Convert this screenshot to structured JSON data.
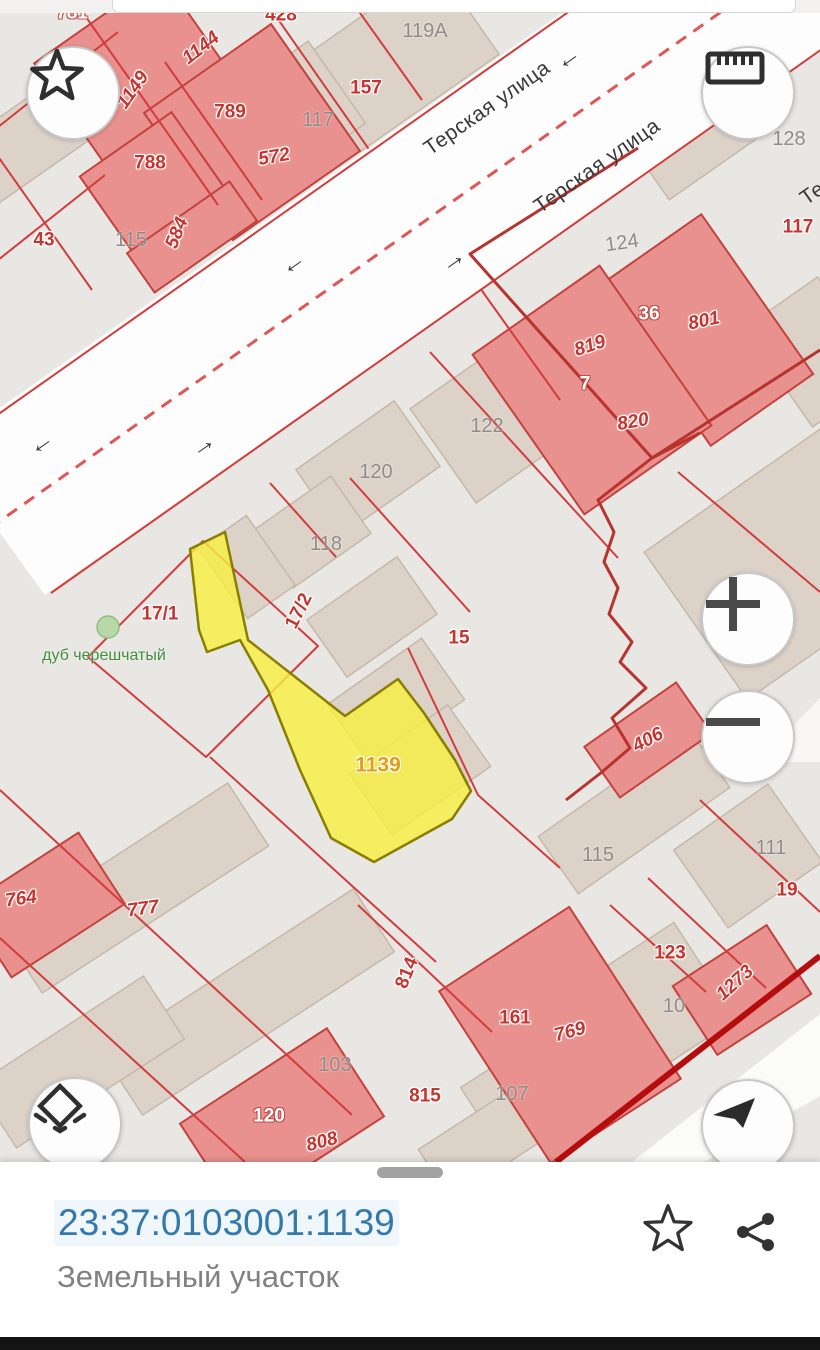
{
  "map": {
    "selected_parcel": {
      "number": "1139",
      "fill": "#f7f03e",
      "outline": "#8a7e00"
    },
    "labels": [
      {
        "text": "781",
        "x": 72,
        "y": 13,
        "rot": 0,
        "style": "wb"
      },
      {
        "text": "428",
        "x": 281,
        "y": 15,
        "rot": 0,
        "style": "rb"
      },
      {
        "text": "1149",
        "x": 133,
        "y": 90,
        "rot": -55,
        "style": "ri"
      },
      {
        "text": "1144",
        "x": 201,
        "y": 48,
        "rot": -38,
        "style": "ri"
      },
      {
        "text": "789",
        "x": 230,
        "y": 112,
        "rot": 0,
        "style": "rb"
      },
      {
        "text": "572",
        "x": 274,
        "y": 157,
        "rot": -10,
        "style": "ri"
      },
      {
        "text": "788",
        "x": 150,
        "y": 163,
        "rot": 0,
        "style": "rb"
      },
      {
        "text": "584",
        "x": 177,
        "y": 233,
        "rot": -68,
        "style": "ri"
      },
      {
        "text": "43",
        "x": 44,
        "y": 240,
        "rot": 0,
        "style": "rb"
      },
      {
        "text": "115",
        "x": 131,
        "y": 240,
        "rot": 0,
        "style": "gy"
      },
      {
        "text": "157",
        "x": 366,
        "y": 88,
        "rot": 0,
        "style": "rb"
      },
      {
        "text": "117",
        "x": 318,
        "y": 120,
        "rot": 0,
        "style": "gy"
      },
      {
        "text": "119A",
        "x": 425,
        "y": 31,
        "rot": 0,
        "style": "gy"
      },
      {
        "text": "124",
        "x": 622,
        "y": 243,
        "rot": -8,
        "style": "gy"
      },
      {
        "text": "36",
        "x": 649,
        "y": 314,
        "rot": 0,
        "style": "wb"
      },
      {
        "text": "801",
        "x": 704,
        "y": 321,
        "rot": -12,
        "style": "ri"
      },
      {
        "text": "819",
        "x": 590,
        "y": 346,
        "rot": -18,
        "style": "ri"
      },
      {
        "text": "7",
        "x": 585,
        "y": 384,
        "rot": 0,
        "style": "wb"
      },
      {
        "text": "820",
        "x": 633,
        "y": 422,
        "rot": -10,
        "style": "ri"
      },
      {
        "text": "122",
        "x": 487,
        "y": 426,
        "rot": 0,
        "style": "gy"
      },
      {
        "text": "117",
        "x": 798,
        "y": 227,
        "rot": 0,
        "style": "rb"
      },
      {
        "text": "128",
        "x": 789,
        "y": 139,
        "rot": 0,
        "style": "gy"
      },
      {
        "text": "120",
        "x": 376,
        "y": 472,
        "rot": 0,
        "style": "gy"
      },
      {
        "text": "118",
        "x": 326,
        "y": 544,
        "rot": 0,
        "style": "gy"
      },
      {
        "text": "17/1",
        "x": 160,
        "y": 614,
        "rot": 0,
        "style": "rb"
      },
      {
        "text": "17/2",
        "x": 299,
        "y": 611,
        "rot": -63,
        "style": "rb"
      },
      {
        "text": "дуб черешчатый",
        "x": 104,
        "y": 656,
        "rot": 0,
        "style": "gr"
      },
      {
        "text": "15",
        "x": 459,
        "y": 638,
        "rot": 0,
        "style": "rb"
      },
      {
        "text": "1139",
        "x": 378,
        "y": 765,
        "rot": 0,
        "style": "or"
      },
      {
        "text": "406",
        "x": 648,
        "y": 740,
        "rot": -28,
        "style": "ri"
      },
      {
        "text": "115",
        "x": 598,
        "y": 855,
        "rot": 0,
        "style": "gy"
      },
      {
        "text": "111",
        "x": 771,
        "y": 848,
        "rot": 0,
        "style": "gy"
      },
      {
        "text": "19",
        "x": 787,
        "y": 890,
        "rot": 0,
        "style": "rb"
      },
      {
        "text": "123",
        "x": 670,
        "y": 953,
        "rot": 0,
        "style": "rb"
      },
      {
        "text": "10",
        "x": 674,
        "y": 1006,
        "rot": 0,
        "style": "gy"
      },
      {
        "text": "1273",
        "x": 735,
        "y": 983,
        "rot": -42,
        "style": "ri"
      },
      {
        "text": "764",
        "x": 21,
        "y": 899,
        "rot": -8,
        "style": "ri"
      },
      {
        "text": "777",
        "x": 143,
        "y": 909,
        "rot": -8,
        "style": "ri"
      },
      {
        "text": "120",
        "x": 269,
        "y": 1116,
        "rot": 0,
        "style": "wb"
      },
      {
        "text": "808",
        "x": 322,
        "y": 1142,
        "rot": -15,
        "style": "ri"
      },
      {
        "text": "103",
        "x": 335,
        "y": 1065,
        "rot": 0,
        "style": "gy"
      },
      {
        "text": "814",
        "x": 407,
        "y": 973,
        "rot": -68,
        "style": "rb"
      },
      {
        "text": "815",
        "x": 425,
        "y": 1096,
        "rot": 0,
        "style": "rb"
      },
      {
        "text": "161",
        "x": 515,
        "y": 1018,
        "rot": 0,
        "style": "rb"
      },
      {
        "text": "769",
        "x": 570,
        "y": 1032,
        "rot": -15,
        "style": "ri"
      },
      {
        "text": "107",
        "x": 512,
        "y": 1094,
        "rot": 0,
        "style": "gy"
      },
      {
        "text": "Терская улица",
        "x": 487,
        "y": 108,
        "rot": -35,
        "style": "st"
      },
      {
        "text": "Терская улица",
        "x": 597,
        "y": 166,
        "rot": -35,
        "style": "st"
      },
      {
        "text": "Терск",
        "x": 826,
        "y": 184,
        "rot": -35,
        "style": "st"
      }
    ],
    "arrows": [
      {
        "x": 292,
        "y": 262,
        "dir": "left"
      },
      {
        "x": 452,
        "y": 259,
        "dir": "right"
      },
      {
        "x": 40,
        "y": 442,
        "dir": "left"
      },
      {
        "x": 202,
        "y": 444,
        "dir": "right"
      },
      {
        "x": 567,
        "y": 57,
        "dir": "left"
      }
    ]
  },
  "controls": {
    "buttons": [
      {
        "name": "favorite-button",
        "icon": "star-icon"
      },
      {
        "name": "measure-button",
        "icon": "ruler-icon"
      },
      {
        "name": "zoom-in-button",
        "icon": "plus-icon"
      },
      {
        "name": "zoom-out-button",
        "icon": "minus-icon"
      },
      {
        "name": "layers-button",
        "icon": "layers-icon"
      },
      {
        "name": "compass-button",
        "icon": "navigation-arrow-icon"
      }
    ]
  },
  "bottom_sheet": {
    "cadastral_number": "23:37:0103001:1139",
    "object_type": "Земельный участок",
    "actions": [
      {
        "name": "favorite",
        "icon": "star-outline-icon"
      },
      {
        "name": "share",
        "icon": "share-icon"
      }
    ]
  },
  "colors": {
    "accent_blue": "#3579ab",
    "parcel_line": "#d23c3c",
    "selected_fill": "#f7f03e",
    "selected_outline": "#8a7e00",
    "building_red": "#e8918e",
    "building_beige": "#dcd2c8",
    "quarter_boundary": "#b50d0d",
    "street_text": "#3a3a3a"
  }
}
